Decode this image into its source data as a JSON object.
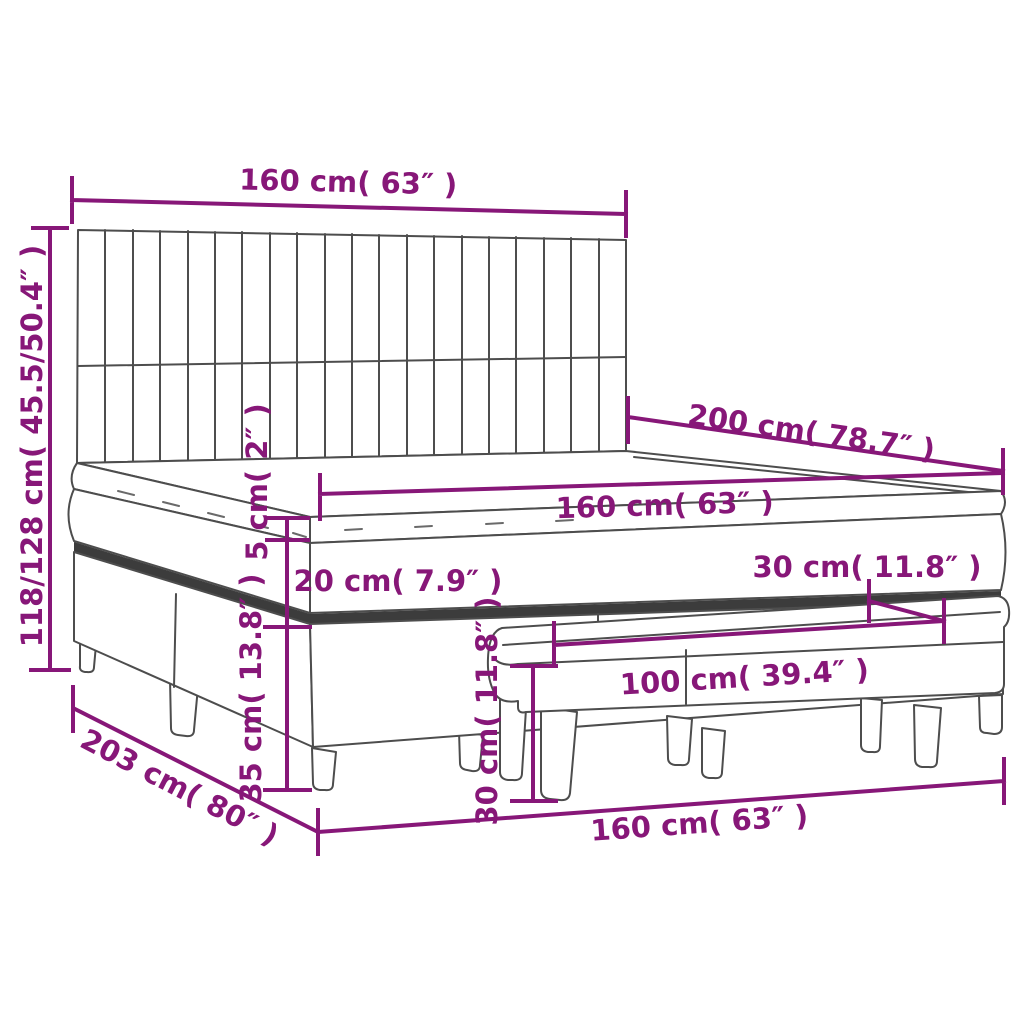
{
  "diagram": {
    "depicts": "box spring bed with vertically striped headboard, mattress with topper, and upholstered bench in front",
    "colors": {
      "dimension_accent": "#871778",
      "outline": "#4d4d4d",
      "background": "#ffffff"
    },
    "dimensions": {
      "headboard_width": {
        "label": "160 cm( 63″ )",
        "cm": 160,
        "inches": 63
      },
      "overall_height": {
        "label": "118/128 cm( 45.5/50.4″ )",
        "cm": "118/128",
        "inches": "45.5/50.4"
      },
      "bed_length": {
        "label": "200 cm( 78.7″ )",
        "cm": 200,
        "inches": 78.7
      },
      "mattress_width": {
        "label": "160 cm( 63″ )",
        "cm": 160,
        "inches": 63
      },
      "topper_thickness": {
        "label": "5 cm( 2″ )",
        "cm": 5,
        "inches": 2
      },
      "mattress_thickness": {
        "label": "20 cm( 7.9″ )",
        "cm": 20,
        "inches": 7.9
      },
      "base_height": {
        "label": "35 cm( 13.8″ )",
        "cm": 35,
        "inches": 13.8
      },
      "bench_depth": {
        "label": "30 cm( 11.8″ )",
        "cm": 30,
        "inches": 11.8
      },
      "bench_length": {
        "label": "100 cm( 39.4″ )",
        "cm": 100,
        "inches": 39.4
      },
      "bench_height": {
        "label": "30 cm( 11.8″ )",
        "cm": 30,
        "inches": 11.8
      },
      "floor_length": {
        "label": "203 cm( 80″ )",
        "cm": 203,
        "inches": 80
      },
      "floor_width": {
        "label": "160 cm( 63″ )",
        "cm": 160,
        "inches": 63
      }
    }
  }
}
